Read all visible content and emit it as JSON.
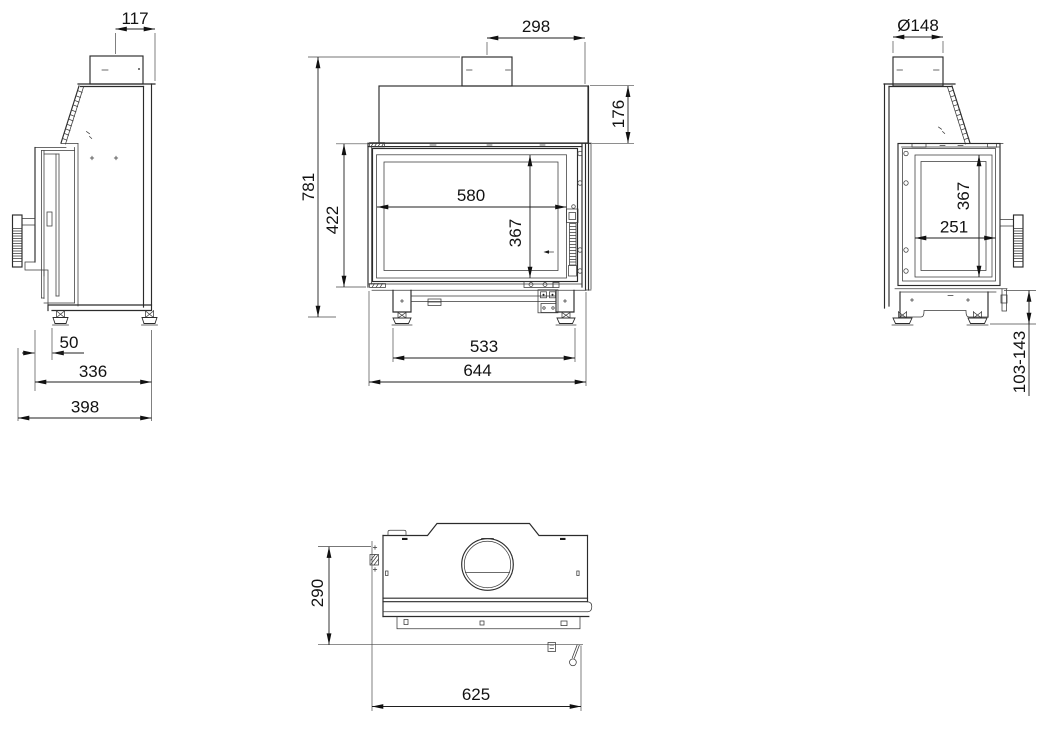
{
  "page": {
    "background": "#ffffff",
    "line_color": "#222222"
  },
  "views": {
    "side_left": {
      "dim_flue_offset": "117",
      "dim_front_to_foot": "50",
      "dim_body_depth": "336",
      "dim_total_depth": "398"
    },
    "front": {
      "dim_flue_center_to_right_edge": "298",
      "dim_hood_height": "176",
      "dim_total_height": "781",
      "dim_firebox_height": "422",
      "dim_glass_width": "580",
      "dim_glass_height": "367",
      "dim_feet_span": "533",
      "dim_total_width": "644"
    },
    "side_right": {
      "dim_flue_diameter": "Ø148",
      "dim_side_glass_height": "367",
      "dim_side_glass_width": "251",
      "dim_base_height_range": "103-143"
    },
    "top": {
      "dim_depth": "290",
      "dim_width": "625"
    }
  }
}
